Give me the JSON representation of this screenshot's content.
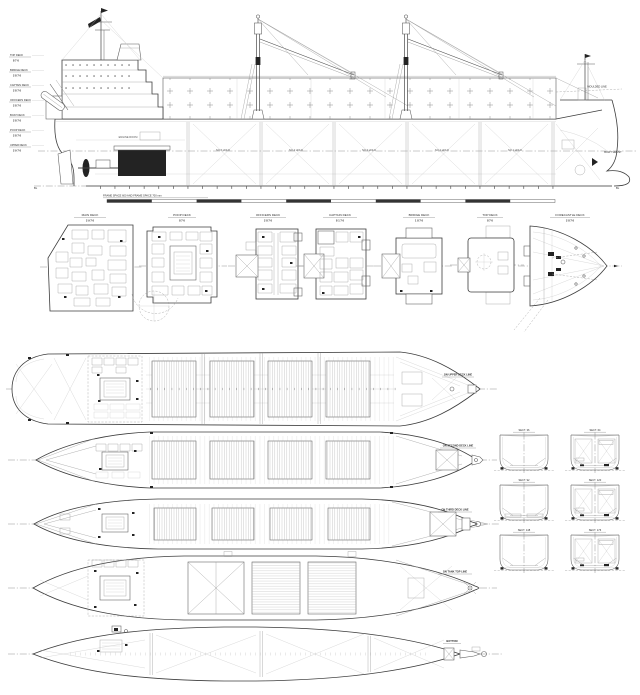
{
  "colors": {
    "ink": "#3d3d3d",
    "paper": "#ffffff"
  },
  "profile": {
    "deck_ladder": [
      {
        "label": "TOP DECK",
        "dim": "8 7 6"
      },
      {
        "label": "BRIDGE DECK",
        "dim": "2 8 7 6"
      },
      {
        "label": "CAPTAIN DECK",
        "dim": "2 8 7 6"
      },
      {
        "label": "OFFICERS DECK",
        "dim": "2 8 7 6"
      },
      {
        "label": "BOAT DECK",
        "dim": "2 8 7 6"
      },
      {
        "label": "POOP DECK",
        "dim": "2 8 7 6"
      },
      {
        "label": "UPPER DECK",
        "dim": "2 9 7 6"
      }
    ],
    "holds": [
      "NO.5 HOLD",
      "NO.4 HOLD",
      "NO.3 HOLD",
      "NO.2 HOLD",
      "NO.1 HOLD"
    ],
    "engine_room": "ENGINE ROOM",
    "moulded_line": "MOULDED LINE",
    "bow_thrust": "BOW THRUST",
    "frame_note": "FRAME SPACE 600 AND FRAME SPACE 700 mm",
    "bl_left": "BL",
    "bl_right": "BL"
  },
  "midplans": [
    {
      "title": "MAIN DECK",
      "dim": "2 9 7 6"
    },
    {
      "title": "POOP DECK",
      "dim": "8 7 6"
    },
    {
      "title": "OFFICERS DECK",
      "dim": "2 8 7 6"
    },
    {
      "title": "CAPTAIN DECK",
      "dim": "8 1 7 6"
    },
    {
      "title": "BRIDGE DECK",
      "dim": "1 8 7 6"
    },
    {
      "title": "TOP DECK",
      "dim": "8 7 6"
    },
    {
      "title": "FORECASTLE DECK",
      "dim": "2 8 7 6"
    }
  ],
  "bottomplans": [
    {
      "label": "ON UPPER DECK LINE"
    },
    {
      "label": "ON SECOND DECK LINE"
    },
    {
      "label": "ON THIRD DECK LINE"
    },
    {
      "label": "ON TANK TOP LINE"
    },
    {
      "label": "BOTTOM"
    }
  ],
  "sections": [
    {
      "title": "SECT. 36"
    },
    {
      "title": "SECT. 64"
    },
    {
      "title": "SECT. 92"
    },
    {
      "title": "SECT. 120"
    },
    {
      "title": "SECT. 148"
    },
    {
      "title": "SECT. 176"
    }
  ]
}
